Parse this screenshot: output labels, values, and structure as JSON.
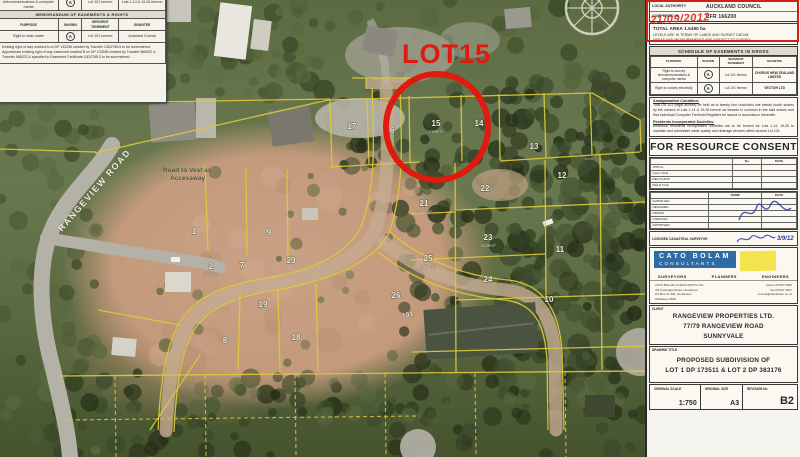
{
  "annotations": {
    "lot_callout": "LOT15",
    "stamp_date": "21/09/2012",
    "red_color": "#df1a0e"
  },
  "map": {
    "road_label": "RANGEVIEW ROAD",
    "road_note_line1": "Road to Vest as",
    "road_note_line2": "Accessway",
    "access_lot_label": "101",
    "lots": [
      {
        "num": "17",
        "x": 352,
        "y": 129
      },
      {
        "num": "16",
        "x": 390,
        "y": 133
      },
      {
        "num": "15",
        "x": 436,
        "y": 126,
        "area": "4169m²"
      },
      {
        "num": "14",
        "x": 479,
        "y": 126
      },
      {
        "num": "13",
        "x": 534,
        "y": 149
      },
      {
        "num": "12",
        "x": 562,
        "y": 178
      },
      {
        "num": "22",
        "x": 485,
        "y": 191
      },
      {
        "num": "21",
        "x": 424,
        "y": 206,
        "area": "4192m²"
      },
      {
        "num": "23",
        "x": 488,
        "y": 240,
        "area": "2539m²"
      },
      {
        "num": "24",
        "x": 488,
        "y": 282
      },
      {
        "num": "25",
        "x": 428,
        "y": 261,
        "area": "2570m²"
      },
      {
        "num": "26",
        "x": 396,
        "y": 298
      },
      {
        "num": "11",
        "x": 560,
        "y": 252
      },
      {
        "num": "10",
        "x": 549,
        "y": 302
      },
      {
        "num": "1",
        "x": 194,
        "y": 234
      },
      {
        "num": "2",
        "x": 211,
        "y": 269,
        "area": "4105m²"
      },
      {
        "num": "7",
        "x": 242,
        "y": 268
      },
      {
        "num": "9",
        "x": 269,
        "y": 235
      },
      {
        "num": "20",
        "x": 291,
        "y": 263
      },
      {
        "num": "19",
        "x": 263,
        "y": 307
      },
      {
        "num": "8",
        "x": 225,
        "y": 343
      },
      {
        "num": "18",
        "x": 296,
        "y": 340
      }
    ]
  },
  "easement_memo": {
    "header": "MEMORANDUM OF EASEMENTS & RIGHTS",
    "partial_row": {
      "purpose": "rights of way, water, telecommunications & computer media",
      "shown": "A",
      "servient": "Lot 101 hereon",
      "grantee": "Lots 1-14 & 19-26 hereon"
    },
    "columns": [
      "PURPOSE",
      "SHOWN",
      "SERVIENT TENEMENT",
      "GRANTEE"
    ],
    "row1": {
      "purpose": "Right to drain water",
      "shown": "A",
      "servient": "Lot 101 hereon",
      "grantee": "Auckland Council"
    },
    "note1": "Existing right of way marked A on DP 133336 created by Transfer C632766.6 to be surrendered.",
    "note2": "Appurtenant existing right of way easement marked B on DP 133336 created by Transfer 666092 & Transfer 668222 & specified in Easement Certificate C632765.3 to be surrendered."
  },
  "sidebar": {
    "local_authority_label": "LOCAL AUTHORITY",
    "local_authority_value": "AUCKLAND COUNCIL",
    "comprised_in_label": "COMPRISED IN",
    "comprised_in_value": "CFR 166200",
    "total_area": "TOTAL AREA  1.5490 ha",
    "datum_note": "LEVELS ARE IN TERMS OF LANDS AND SURVEY DATUM",
    "survey_note": "AREAS AND MEASUREMENTS ARE SUBJECT TO SURVEY",
    "easements": {
      "title": "SCHEDULE OF EASEMENTS IN GROSS",
      "col_purpose": "PURPOSE",
      "col_shown": "SHOWN",
      "col_servient": "SERVIENT TENEMENT",
      "col_grantee": "GRANTEE",
      "rows": [
        {
          "purpose": "Right to convey telecommunications & computer media",
          "shown": "A",
          "servient": "Lot 101 hereon",
          "grantee": "CHORUS NEW ZEALAND LIMITED"
        },
        {
          "purpose": "Right to convey electricity",
          "shown": "A",
          "servient": "Lot 101 hereon",
          "grantee": "VECTOR LTD"
        }
      ]
    },
    "amalgamation_title": "Amalgamation Condition:",
    "amalgamation_text": "That Lot 101 (legal access) be held as to twenty four undivided one twenty fourth shares by the owners of Lots 1-14 & 19-26 hereon as tenants in common in the said shares and that individual Computer Freehold Registers be issued in accordance therewith.",
    "societies_title": "Residents Incorporated Societies:",
    "societies_text": "Individual Residents Incorporated Societies are to be formed for Lots 1-14, 19-26 to maintain and administer water quality and drainage devices within Access Lot 101.",
    "consent_banner": "FOR RESOURCE CONSENT",
    "file_table": {
      "col_b": "No",
      "col_c": "DATE",
      "rows": [
        "JOB No",
        "CALC FILE",
        "REF PLANS",
        "FIELD FILE"
      ]
    },
    "approval_table": {
      "col_name": "NAME",
      "col_date": "DATE",
      "rows": [
        "SURVEYED",
        "DESIGNED",
        "DRAWN",
        "CHECKED",
        "APPROVED"
      ],
      "sig_date": "3/9/12"
    },
    "surveyor_row_label": "LICENSED CADASTRAL SURVEYOR",
    "firm": {
      "name_line1": "CATO BOLAM",
      "name_line2": "CONSULTANTS",
      "disc1": "SURVEYORS",
      "disc2": "PLANNERS",
      "disc3": "ENGINEERS",
      "contact_l1": "CATO BOLAM CONSULTANTS LTD",
      "contact_l2": "4/3 Cartwright Road, Henderson",
      "contact_l3": "PO Box 21 445, Henderson",
      "contact_l4": "Waitakere 0650",
      "contact_r1": "phone 09 837 0966",
      "contact_r2": "fax 09 837 5947",
      "contact_r3": "consult@catobolam.co.nz"
    },
    "client_label": "CLIENT",
    "client_line1": "RANGEVIEW PROPERTIES LTD.",
    "client_line2": "77/79 RANGEVIEW ROAD",
    "client_line3": "SUNNYVALE",
    "title_label": "DRAWING TITLE",
    "title_line1": "PROPOSED SUBDIVISION OF",
    "title_line2": "LOT 1 DP 173511 & LOT 2 DP 383176",
    "scale_label": "ORIGINAL SCALE",
    "scale_value": "1:750",
    "size_label": "ORIGINAL SIZE",
    "size_value": "A3",
    "rev_label": "REVISION No",
    "rev_value": "B2"
  }
}
